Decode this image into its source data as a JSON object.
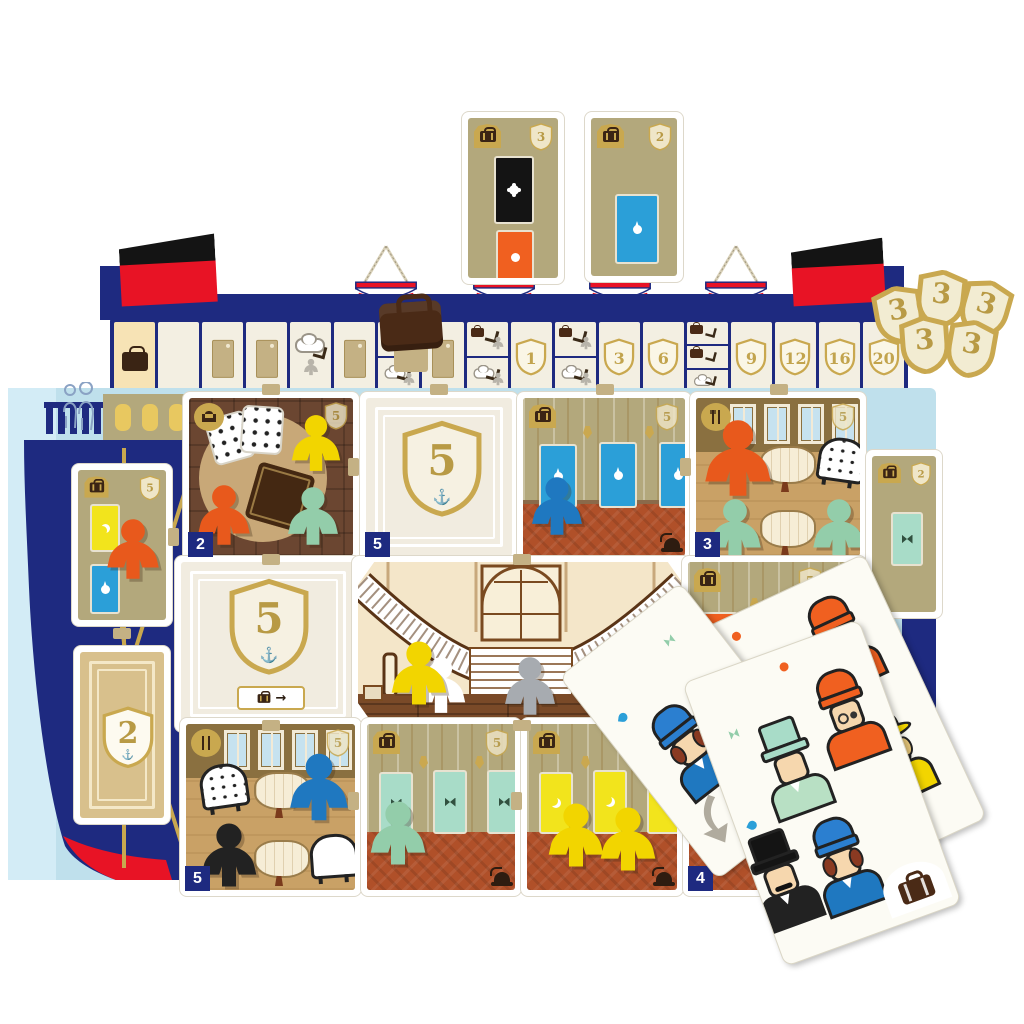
{
  "scene": {
    "description": "Ocean-liner board game: ship-shaped score board with funnels, lifeboats and score track; room tiles with wooden meeples; passenger cards; gold shield victory tokens",
    "background": "#ffffff"
  },
  "colors": {
    "navy": "#1e2a80",
    "red": "#e81325",
    "gold": "#c9a84f",
    "tan_wall": "#b3a87c",
    "light_blue": "#bfe0ec",
    "cream": "#f7e3b5",
    "terracotta": "#b05029",
    "meeple_yellow": "#f2d500",
    "meeple_orange": "#e8591c",
    "meeple_mint": "#93cdaa",
    "meeple_blue": "#1f78c0",
    "meeple_gray": "#a7abb0",
    "meeple_black": "#222222",
    "door_blue": "#2b9fd8",
    "door_yellow": "#f2e41c",
    "door_mint": "#a8dcc8",
    "door_orange": "#f06020",
    "door_black": "#141414"
  },
  "icons": {
    "anchor": "⚓",
    "arrow_right": "→"
  },
  "top_cabin_tiles": [
    {
      "badge": "3",
      "doors": [
        "black-flower",
        "orange-ring"
      ]
    },
    {
      "badge": "2",
      "doors": [
        "blue-drop"
      ]
    }
  ],
  "score_track": {
    "shields": [
      "1",
      "3",
      "6",
      "9",
      "12",
      "16",
      "20"
    ],
    "icon_cells": [
      "suitcase",
      "door",
      "smoke-exchange",
      "suitcase-exchange"
    ],
    "token_on_track": "brown-suitcase-piece"
  },
  "shield_tokens": {
    "value": "3",
    "count": 5
  },
  "tiles": {
    "lounge": {
      "corner": "2",
      "badge": "5",
      "meeples": [
        "yellow",
        "orange",
        "mint"
      ]
    },
    "anchor_score_top": {
      "corner": "5",
      "shield_value": "5"
    },
    "cabin_blue": {
      "badge": "5",
      "meeples": [
        "blue"
      ],
      "door_color": "blue"
    },
    "dining_top": {
      "corner": "3",
      "badge": "5",
      "meeples": [
        "orange",
        "mint",
        "mint"
      ]
    },
    "anchor_score_mid": {
      "shield_value": "5"
    },
    "grand_staircase": {
      "meeples": [
        "yellow",
        "gray",
        "gray"
      ]
    },
    "cabin_orange": {
      "badge": "5",
      "door_color": "orange"
    },
    "dining_bottom": {
      "corner": "5",
      "badge": "5",
      "meeples": [
        "blue",
        "black"
      ]
    },
    "cabin_mint": {
      "badge": "5",
      "meeples": [
        "mint"
      ],
      "door_color": "mint"
    },
    "cabin_yellow": {
      "meeples": [
        "yellow",
        "yellow"
      ],
      "door_color": "yellow"
    },
    "hidden_tile": {
      "corner": "4"
    },
    "hull_cabin": {
      "badge": "5",
      "meeples": [
        "orange"
      ],
      "door_colors": [
        "yellow",
        "blue"
      ]
    },
    "hull_score": {
      "shield_value": "2"
    },
    "cabin_right": {
      "badge": "2",
      "door_color": "mint"
    }
  },
  "cards": [
    {
      "passengers": [
        "woman-blue-hat"
      ],
      "icons": [
        "gray-arrow",
        "green-bow"
      ]
    },
    {
      "passengers": [
        "man-orange-hat",
        "man-green-tophat",
        "woman-yellow-hat"
      ],
      "icons": [
        "orange-dot",
        "yellow-moon"
      ]
    },
    {
      "passengers": [
        "man-green-tophat-suit",
        "man-orange-hat",
        "man-black-tophat",
        "woman-blue-hat"
      ],
      "icons": [
        "suitcase",
        "orange-dot"
      ]
    }
  ]
}
